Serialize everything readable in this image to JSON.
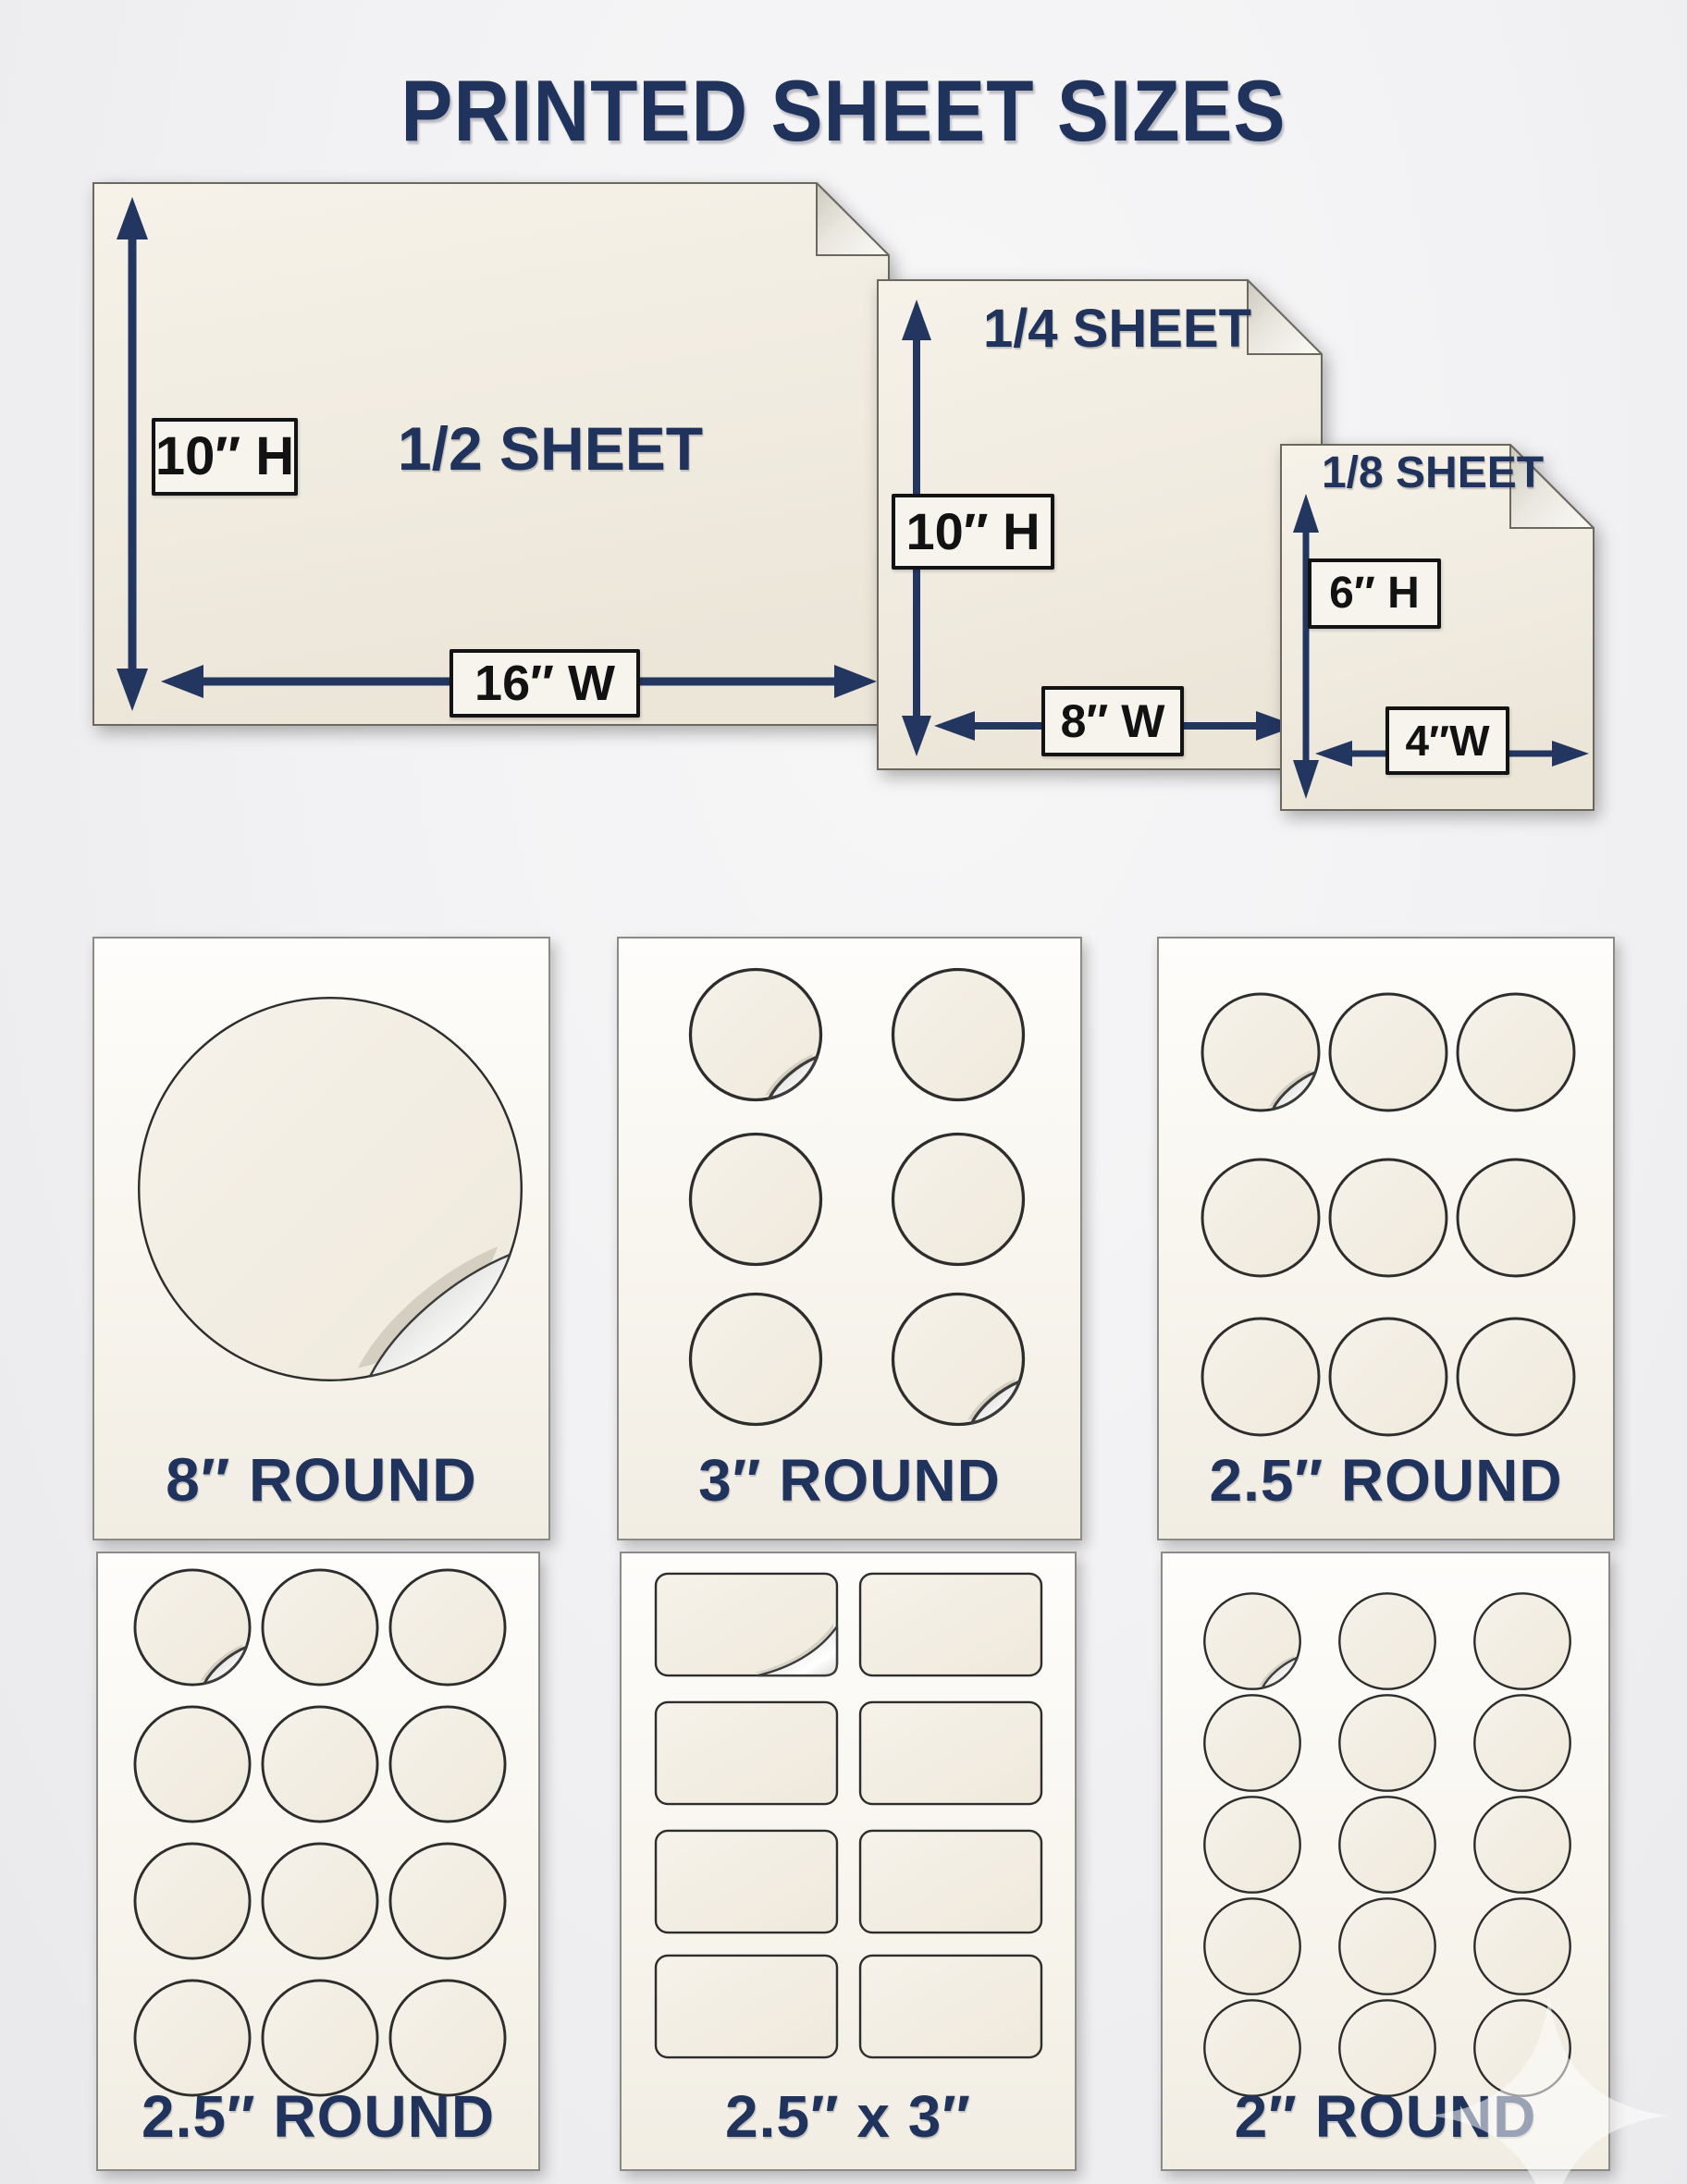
{
  "title": "PRINTED SHEET SIZES",
  "colors": {
    "navy": "#20335c",
    "sheet_cream": "#f1ecdf",
    "sticker_cream": "#f4efe5",
    "dimension_text": "#121212"
  },
  "sheets": [
    {
      "name": "1/2 SHEET",
      "height": "10″ H",
      "width": "16″ W"
    },
    {
      "name": "1/4 SHEET",
      "height": "10″ H",
      "width": "8″ W"
    },
    {
      "name": "1/8 SHEET",
      "height": "6″ H",
      "width": "4″W"
    }
  ],
  "panels": [
    {
      "label": "8″ ROUND",
      "sticker_shape": "circle",
      "columns": 1,
      "rows": 1,
      "count": 1,
      "peeled": [
        0
      ]
    },
    {
      "label": "3″ ROUND",
      "sticker_shape": "circle",
      "columns": 2,
      "rows": 3,
      "count": 6,
      "peeled": [
        0,
        5
      ]
    },
    {
      "label": "2.5″ ROUND",
      "sticker_shape": "circle",
      "columns": 3,
      "rows": 3,
      "count": 9,
      "peeled": [
        0
      ]
    },
    {
      "label": "2.5″ ROUND",
      "sticker_shape": "circle",
      "columns": 3,
      "rows": 4,
      "count": 12,
      "peeled": [
        0
      ]
    },
    {
      "label": "2.5″ x 3″",
      "sticker_shape": "rounded-rect",
      "columns": 2,
      "rows": 4,
      "count": 8,
      "peeled": [
        0
      ]
    },
    {
      "label": "2″ ROUND",
      "sticker_shape": "circle",
      "columns": 3,
      "rows": 5,
      "count": 15,
      "peeled": [
        0
      ]
    }
  ]
}
